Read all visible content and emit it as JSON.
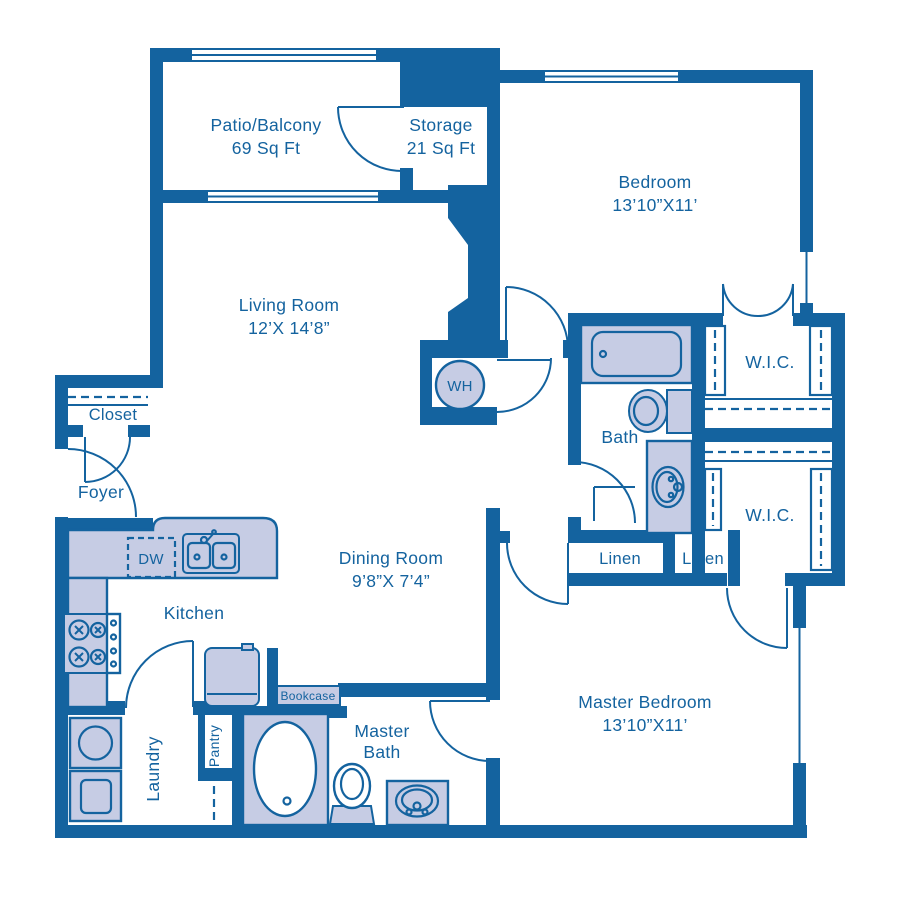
{
  "colors": {
    "wall_blue": "#14639F",
    "fixture_lavender": "#C6CCE4",
    "background": "#FFFFFF"
  },
  "rooms": {
    "patio": {
      "name": "Patio/Balcony",
      "area": "69 Sq Ft"
    },
    "storage": {
      "name": "Storage",
      "area": "21 Sq Ft"
    },
    "bedroom": {
      "name": "Bedroom",
      "dims": "13’10”X11’"
    },
    "living_room": {
      "name": "Living Room",
      "dims": "12’X 14’8”"
    },
    "dining_room": {
      "name": "Dining Room",
      "dims": "9’8”X 7’4”"
    },
    "master_bedroom": {
      "name": "Master Bedroom",
      "dims": "13’10”X11’"
    },
    "kitchen": {
      "name": "Kitchen"
    },
    "bath": {
      "name": "Bath"
    },
    "master_bath": {
      "line1": "Master",
      "line2": "Bath"
    },
    "foyer": {
      "name": "Foyer"
    },
    "closet": {
      "name": "Closet"
    },
    "laundry": {
      "name": "Laundry"
    },
    "pantry": {
      "name": "Pantry"
    },
    "wic_upper": {
      "name": "W.I.C."
    },
    "wic_lower": {
      "name": "W.I.C."
    },
    "linen_left": {
      "name": "Linen"
    },
    "linen_right": {
      "name": "Linen"
    }
  },
  "fixtures": {
    "water_heater": "WH",
    "dishwasher": "DW",
    "bookcase": "Bookcase"
  }
}
